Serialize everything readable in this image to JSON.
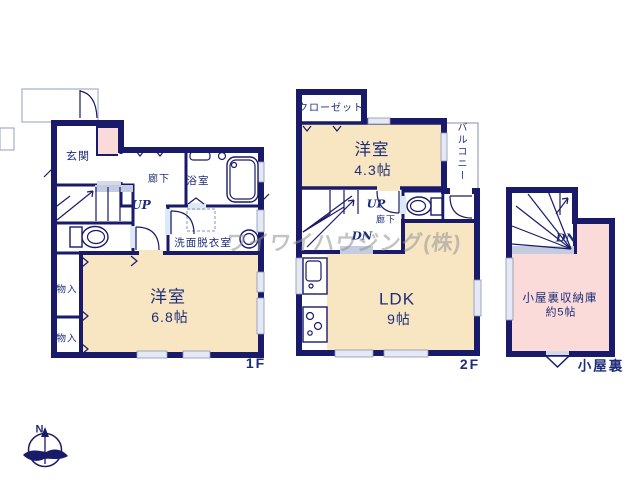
{
  "watermark": "ワイワイハウジング(株)",
  "colors": {
    "wall": "#1a1a6b",
    "ink": "#1e2d78",
    "cream": "#f8e6c2",
    "pink": "#fadbd9",
    "blue": "#dce9f7",
    "landing": "#c6cce0",
    "lightline": "#8a93b5"
  },
  "compass": {
    "north_label": "N"
  },
  "floor1": {
    "label": "1F",
    "rooms": {
      "genkan": "玄関",
      "hallway": "廊下",
      "up": "UP",
      "bath": "浴室",
      "washroom": "洗面脱衣室",
      "room_name": "洋室",
      "room_size": "6.8帖",
      "storage1": "物入",
      "storage2": "物入"
    }
  },
  "floor2": {
    "label": "2F",
    "rooms": {
      "closet": "クローゼット",
      "room_name": "洋室",
      "room_size": "4.3帖",
      "balcony": "バルコニー",
      "up": "UP",
      "hallway": "廊下",
      "dn": "DN",
      "ldk_name": "LDK",
      "ldk_size": "9帖"
    }
  },
  "attic": {
    "label": "小屋裏",
    "dn": "DN",
    "storage_name": "小屋裏収納庫",
    "storage_size": "約5帖"
  }
}
